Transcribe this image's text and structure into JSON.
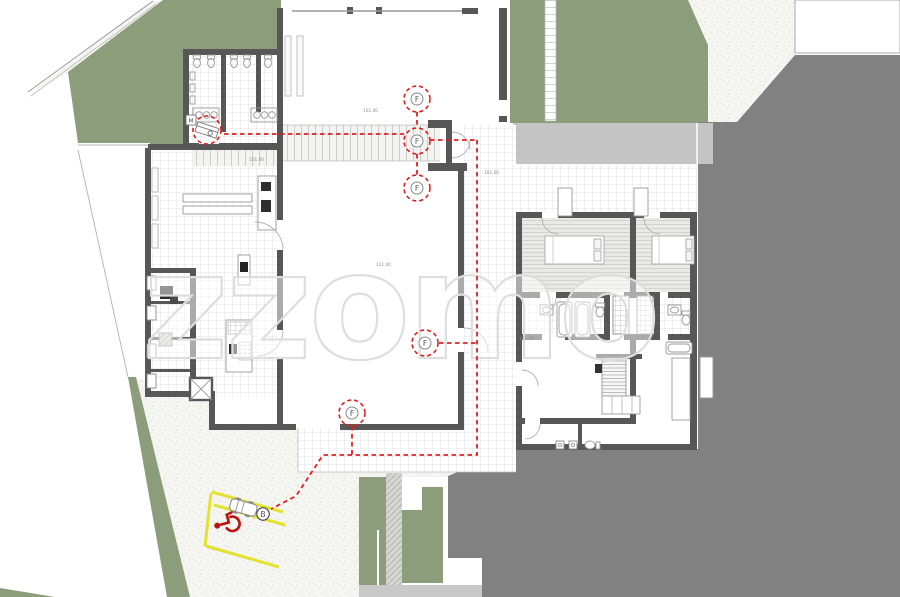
{
  "plan": {
    "watermark": "zzomo",
    "elevation_label": "101.00",
    "markers": {
      "fixture": "F",
      "meter": "M",
      "parking": "B"
    },
    "icons": {
      "accessible_parking": "wheelchair-icon",
      "vehicle": "car-icon",
      "drinking_fountain": "fountain-icon"
    },
    "palette": {
      "landscape_green": "#8C9D7C",
      "roof_gray": "#818181",
      "path_gray": "#C4C4C4",
      "wall_gray": "#575757",
      "route_red": "#E02020",
      "parking_yellow": "#E2E230"
    }
  }
}
